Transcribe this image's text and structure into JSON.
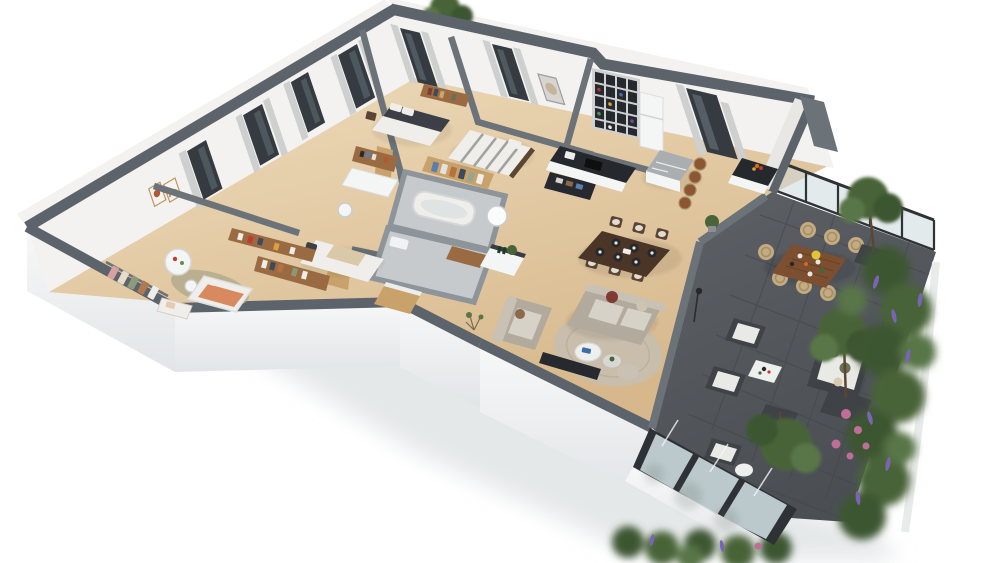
{
  "meta": {
    "description": "Photorealistic 3D isometric cutaway floor plan of an apartment with furnished rooms and a landscaped terrace, on a white background with soft shadows",
    "view": "isometric 3D floor plan render",
    "background": "#ffffff"
  },
  "palette": {
    "bg": "#ffffff",
    "shadow": "#d6dadd",
    "slab_face": "#f7f8f8",
    "slab_shade": "#e2e5e8",
    "wall_cap_dark": "#5c636a",
    "wall_cap_mid": "#6b7278",
    "wall_face": "#f3f2f0",
    "wall_face_shade": "#e8e7e4",
    "bath_wall": "#8d949a",
    "bath_floor": "#c7cacc",
    "floor_wood_light": "#eedcbc",
    "floor_wood_dark": "#d7b88c",
    "terrace_tile": "#5d6166",
    "terrace_tile_dark": "#4b4f54",
    "tile_line": "#44484d",
    "glass": "#ccd9dd",
    "glass_frame": "#2e3236",
    "window_dark": "#353b41",
    "curtain": "#cdd0cf",
    "door_wood": "#c9a26b",
    "furn_wood": "#9a6b42",
    "furn_wood_dark": "#5a4436",
    "table_walnut": "#4a3526",
    "shelf_dark": "#26292e",
    "bed_dark": "#3c4046",
    "linen_white": "#efeeea",
    "linen_stripe": "#8e8e8c",
    "sofa_taupe": "#b2aa9c",
    "sofa_light": "#c8c1b4",
    "rug_living": "#c9bdab",
    "rug_nursery": "#b3aa8b",
    "pillow_red": "#7e3a33",
    "pillow_brown": "#8a6a4a",
    "marble_island": "#aaaeb1",
    "counter_dark": "#25282c",
    "stool_leather": "#8d5632",
    "appliance_white": "#f4f5f5",
    "crib_orange": "#d88a5e",
    "green_dark": "#3e5630",
    "green_mid": "#4a6339",
    "green_light": "#587647",
    "flower_purple": "#7b63b5",
    "flower_pink": "#bf6f97",
    "planter_dark": "#3f4347",
    "wicker": "#c3ab82",
    "wicker_dark": "#a68c62",
    "outdoor_cushion": "#e9e9e5",
    "pillow_olive": "#6b7055",
    "white_table": "#eef0ee",
    "accent_blue": "#3a6ea8",
    "fruit_orange": "#d2691e",
    "lamp_black": "#2a2d30",
    "trunk": "#5b4632",
    "curb_white": "#e9ebea",
    "heater_white": "#fafbfb"
  },
  "rooms": [
    {
      "name": "master-bedroom",
      "items": [
        "double bed with dark duvet",
        "wall shelving",
        "window with curtains"
      ]
    },
    {
      "name": "bedroom-2",
      "items": [
        "double bed with striped duvet",
        "wood headboard",
        "window with curtains"
      ]
    },
    {
      "name": "bedroom-office",
      "items": [
        "white desk with hutch",
        "white chair",
        "single bed",
        "low bookshelf",
        "windows with curtains"
      ]
    },
    {
      "name": "nursery",
      "items": [
        "crib with orange bedding",
        "round kids table",
        "stool",
        "open clothes rail",
        "folded linens",
        "wall shelf",
        "round rug",
        "wall art frames",
        "window with curtain"
      ]
    },
    {
      "name": "bathroom",
      "items": [
        "bathtub",
        "gray tiled walls",
        "water heater",
        "wood bench"
      ]
    },
    {
      "name": "shower-room",
      "items": [
        "gray tiled floor",
        "sanitary fixtures"
      ]
    },
    {
      "name": "walk-in-closet",
      "items": [
        "hanging clothes",
        "wardrobe shelves"
      ]
    },
    {
      "name": "hallway",
      "items": [
        "wood doors",
        "marble-top sideboard",
        "wood cabinet"
      ]
    },
    {
      "name": "kitchen",
      "items": [
        "island with marble top",
        "four leather bar stools",
        "dark stone counters",
        "sink",
        "fridge",
        "bottle bookshelf",
        "tall window with curtains",
        "fruit bowl"
      ]
    },
    {
      "name": "dining-area",
      "items": [
        "walnut dining table",
        "six chairs",
        "dark place settings"
      ]
    },
    {
      "name": "living-room",
      "items": [
        "two taupe sofas",
        "round beige rug",
        "round coffee tables",
        "tv panel",
        "red cushion",
        "floor lamp",
        "pouf",
        "armchair"
      ]
    },
    {
      "name": "terrace",
      "items": [
        "dark stone tiles",
        "outdoor wood dining table",
        "six wicker chairs",
        "lounge armchairs",
        "outdoor sofa with olive pillows",
        "white coffee table",
        "potted trees",
        "glass balustrade",
        "sliding glass doors"
      ]
    },
    {
      "name": "garden-border",
      "items": [
        "hedge planting",
        "purple flower spikes",
        "pink roses",
        "white planter curb"
      ]
    }
  ]
}
